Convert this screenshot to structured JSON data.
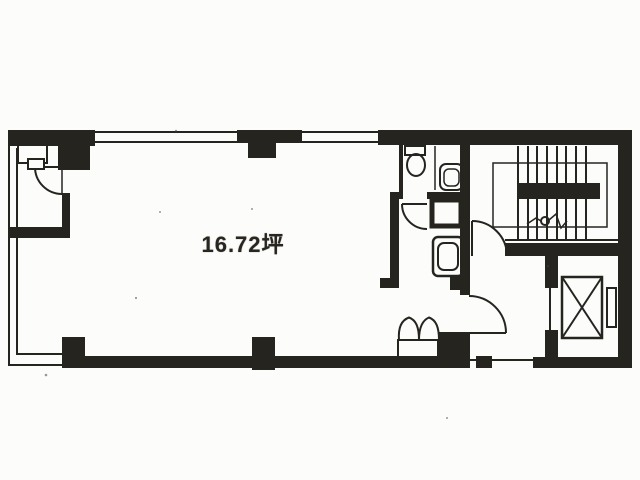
{
  "colors": {
    "ink": "#26241f",
    "paper": "#fcfcfb"
  },
  "floorplan": {
    "area_label": "16.72坪"
  }
}
